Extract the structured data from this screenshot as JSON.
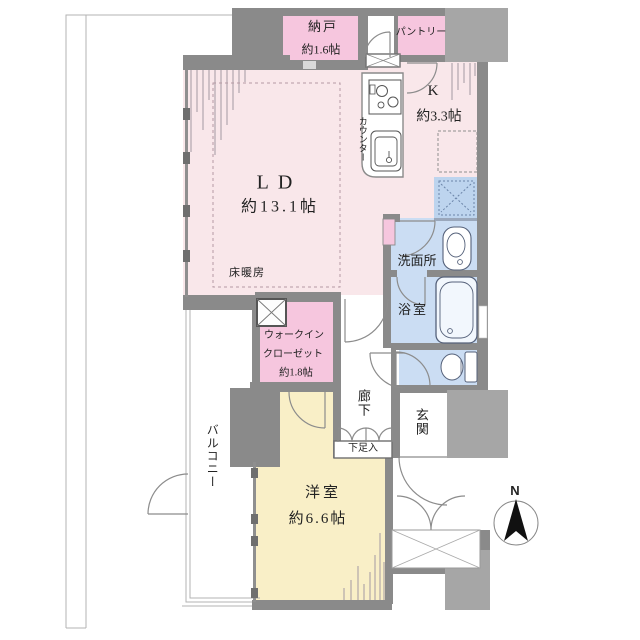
{
  "floorplan": {
    "compass": {
      "north": "N"
    },
    "rooms": {
      "ld": {
        "name": "LD",
        "size": "約13.1帖",
        "floor_heating": "床暖房"
      },
      "nando": {
        "name": "納戸",
        "size": "約1.6帖"
      },
      "pantry": {
        "name": "パントリー"
      },
      "kitchen": {
        "name": "K",
        "size": "約3.3帖",
        "counter": "カウンター"
      },
      "washroom": {
        "name": "洗面所"
      },
      "bathroom": {
        "name": "浴室"
      },
      "wic": {
        "line1": "ウォークイン",
        "line2": "クローゼット",
        "size": "約1.8帖"
      },
      "hallway": {
        "name": "廊下"
      },
      "entrance": {
        "name": "玄関",
        "shoe_cabinet": "下足入"
      },
      "western_room": {
        "name": "洋室",
        "size": "約6.6帖"
      },
      "balcony": {
        "name": "バルコニー"
      }
    },
    "colors": {
      "ld_kitchen_floor": "#f9e7ea",
      "storage_pink": "#f6c6de",
      "wet_area_blue": "#cbddf3",
      "washer_space_blue": "#bdd4ee",
      "western_room_yellow": "#f9efc7",
      "wall_gray": "#8a8a8a",
      "outer_mass_gray": "#a6a6a6"
    }
  }
}
